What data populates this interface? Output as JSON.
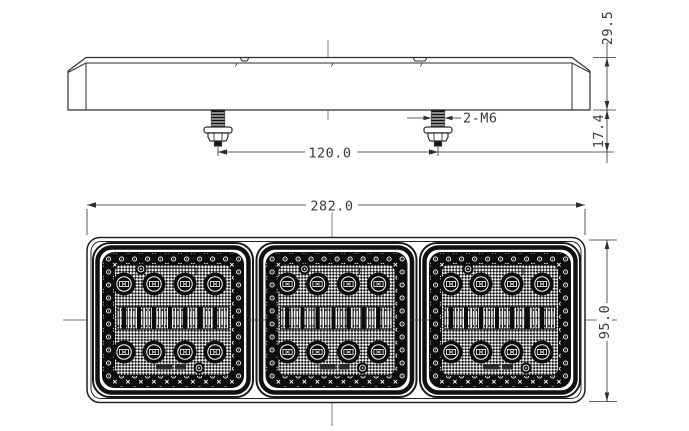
{
  "colors": {
    "background": "#ffffff",
    "line": "#2f2f2f",
    "dim_text": "#3a3a3a"
  },
  "side_view": {
    "dim_total_height": "29.5",
    "dim_stud_length": "17.4",
    "dim_stud_spacing": "120.0",
    "stud_spec": "2-M6",
    "stud_count": 2
  },
  "front_view": {
    "dim_width": "282.0",
    "dim_height": "95.0",
    "module_count": 3,
    "leds_per_module": 8
  }
}
